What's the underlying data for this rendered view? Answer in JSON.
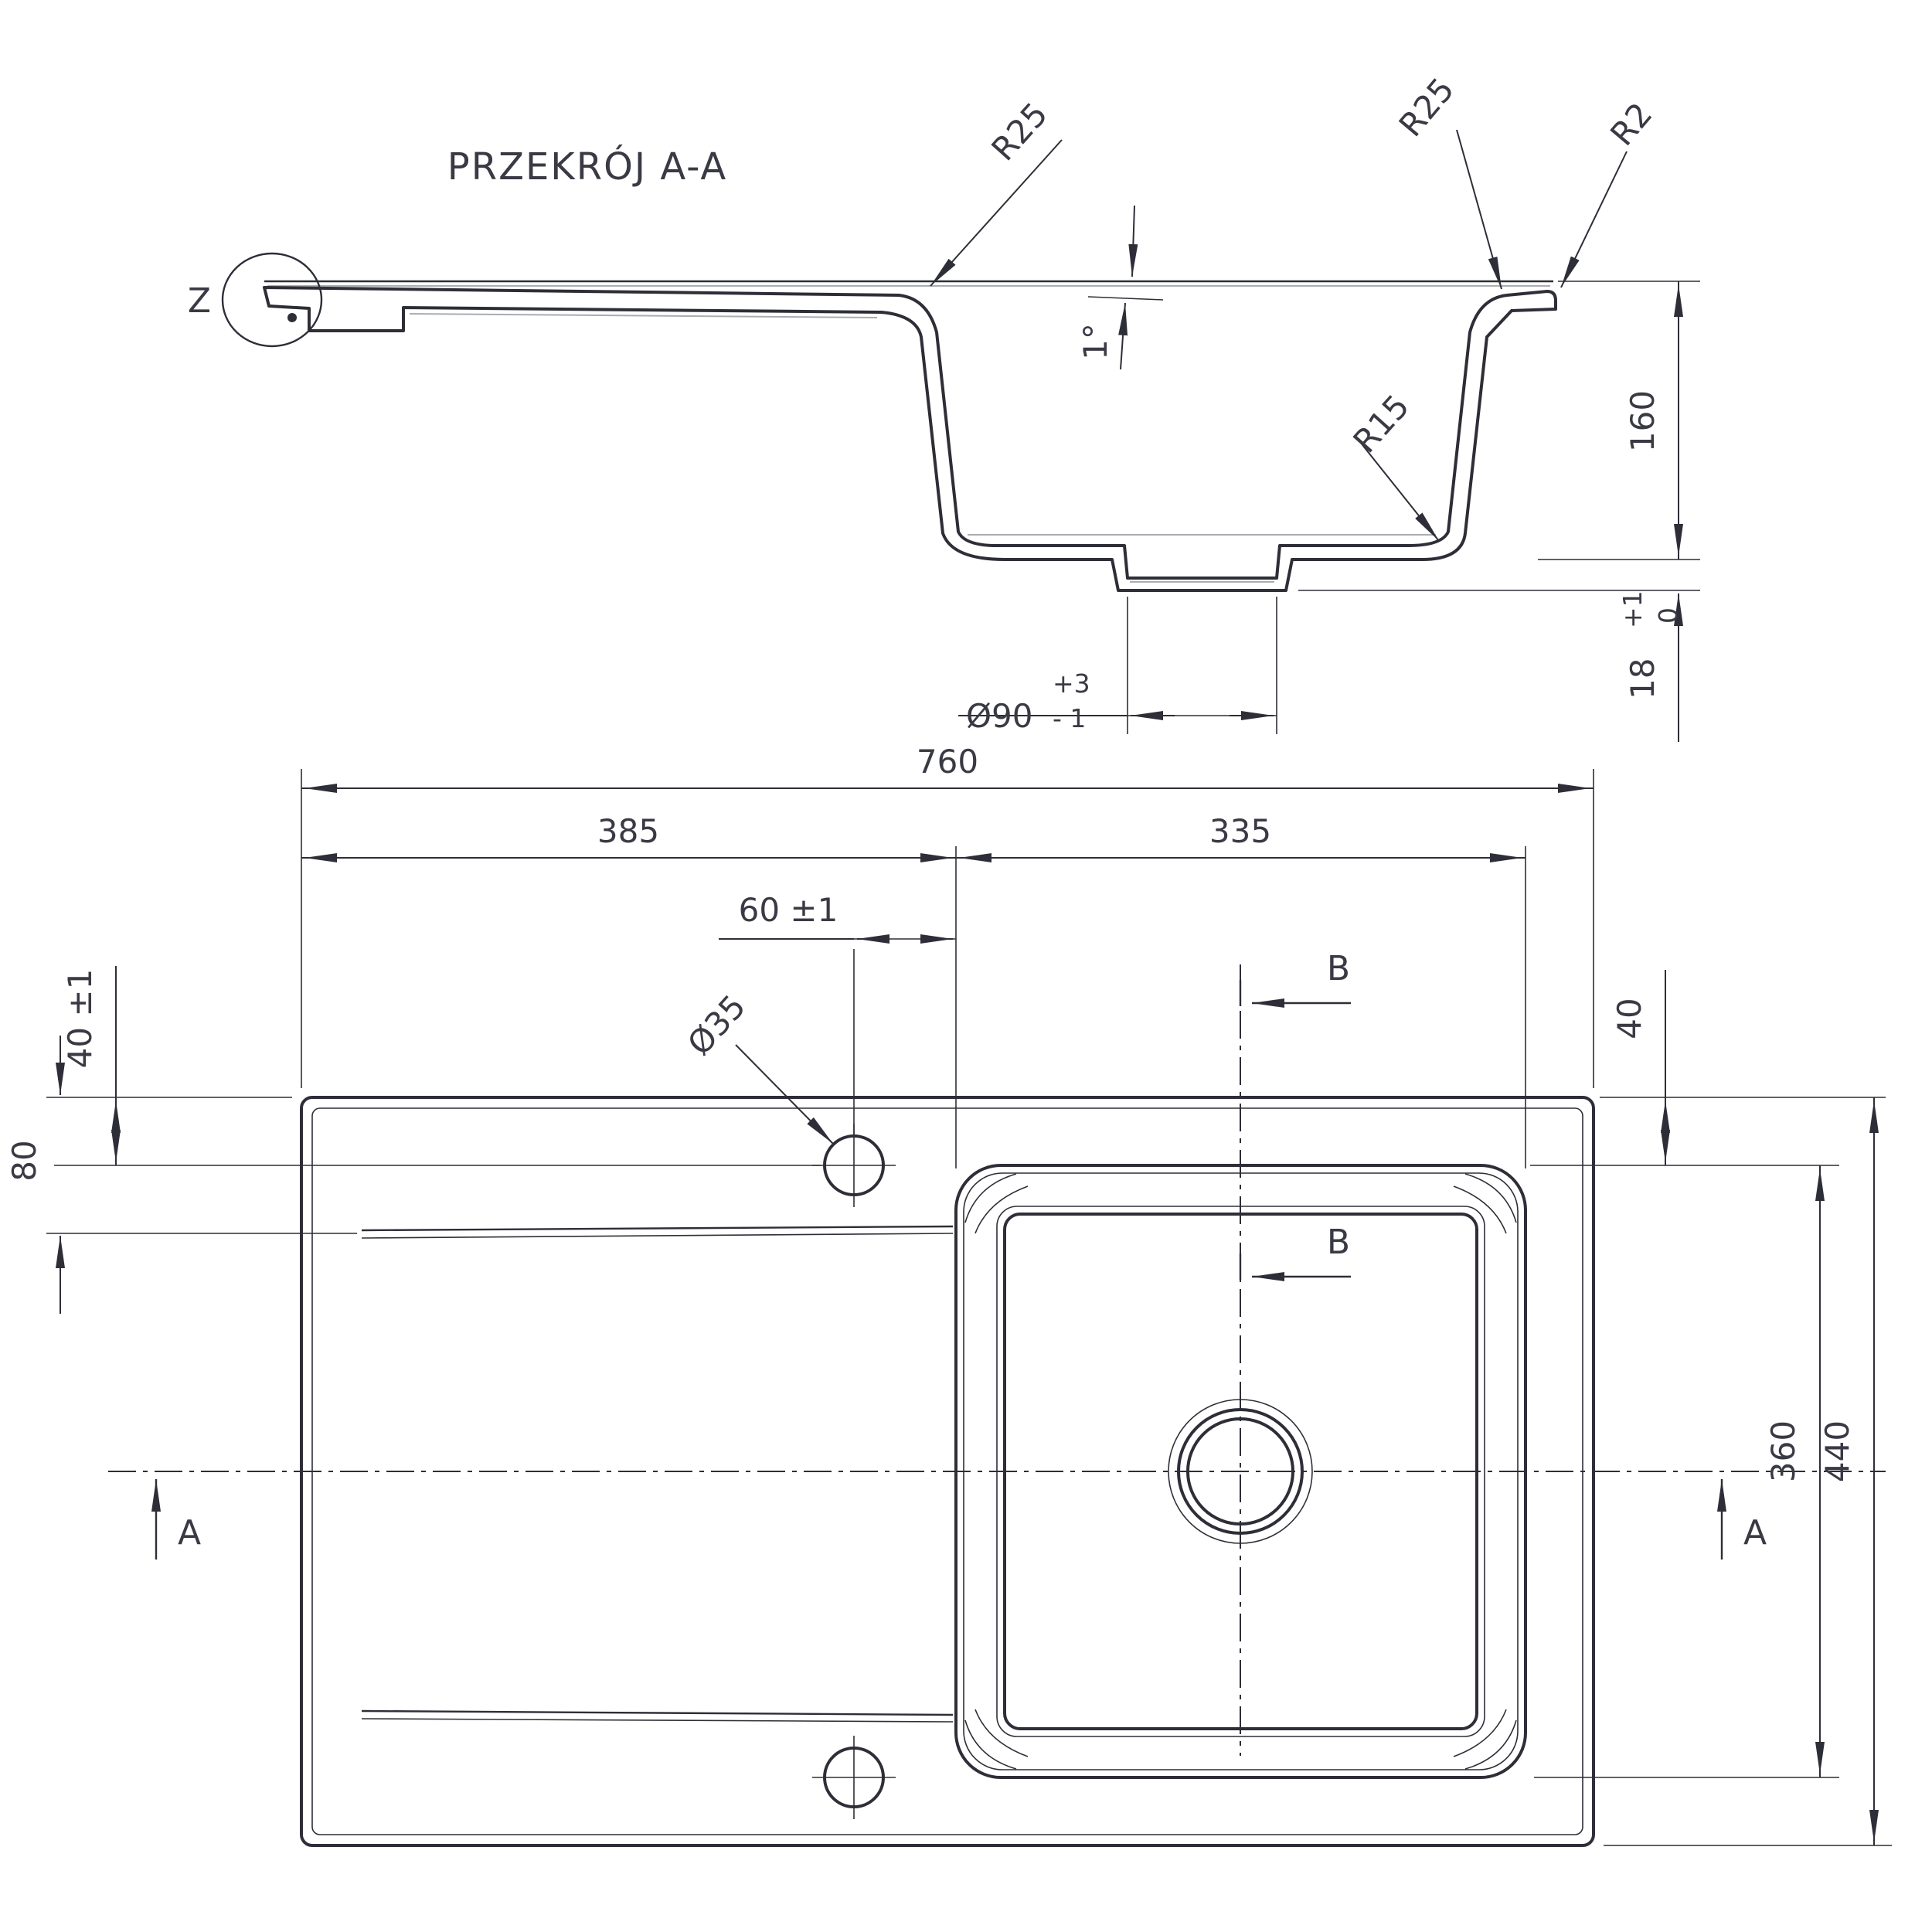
{
  "section": {
    "title": "PRZEKRÓJ A-A",
    "detail_label": "Z",
    "radius_rim": "R25",
    "radius_edge": "R2",
    "radius_bottom": "R15",
    "draft_angle": "1°",
    "depth": "160",
    "lip": {
      "value": "18",
      "tol_plus": "+1",
      "tol_zero": "0"
    },
    "drain": {
      "dia": "Ø90",
      "tol_plus": "+3",
      "tol_minus": "- 1"
    }
  },
  "plan": {
    "overall_width": "760",
    "drainer_width": "385",
    "bowl_width": "335",
    "hole_offset": "60 ±1",
    "hole_dia": "Ø35",
    "hole_from_top": "40 ±1",
    "groove_from_top": "80",
    "bowl_from_top": "40",
    "bowl_length": "360",
    "overall_height": "440",
    "section_a": "A",
    "section_b": "B"
  }
}
